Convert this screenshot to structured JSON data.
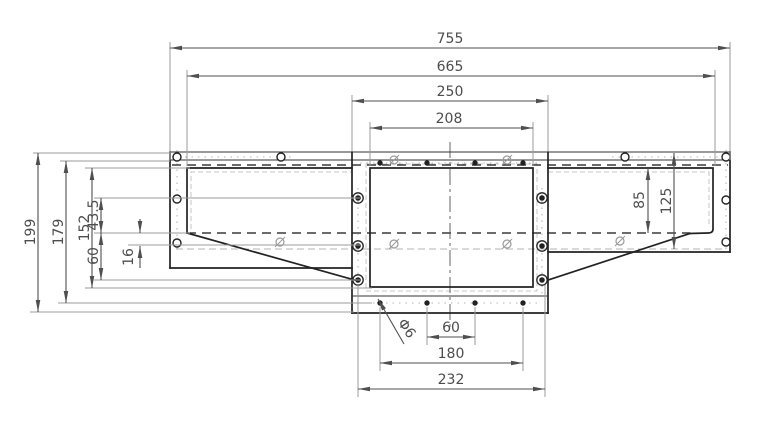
{
  "drawing": {
    "type": "engineering-dimension-drawing",
    "view": "front-view-flanged-transition-duct",
    "dims_top": [
      "755",
      "665",
      "250",
      "208"
    ],
    "dims_left": [
      "199",
      "179",
      "152",
      "43.5",
      "60",
      "16"
    ],
    "dims_right": [
      "85",
      "125"
    ],
    "dims_bottom": [
      "60",
      "180",
      "232"
    ],
    "hole_callout": "Φ6",
    "colors": {
      "background": "#ffffff",
      "part_line": "#222222",
      "dim_line": "#4f4f4f",
      "extension_line": "#9b9b9b",
      "text": "#4d4d4d"
    }
  }
}
